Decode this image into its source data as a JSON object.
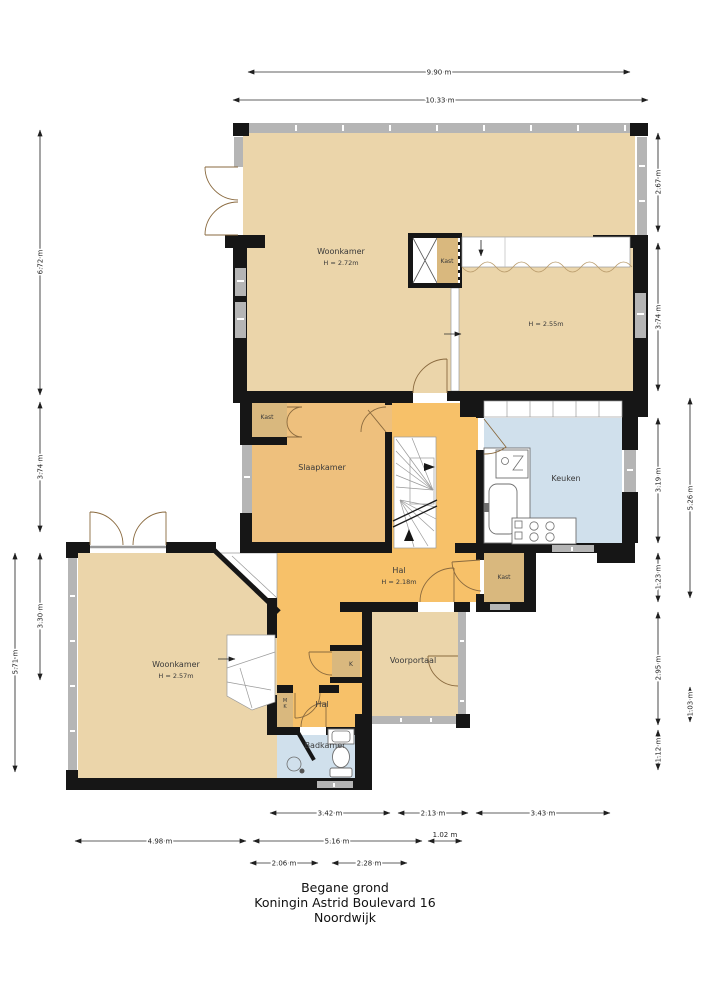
{
  "colors": {
    "room_beige": "#ebd5aa",
    "hall_orange": "#f7c169",
    "slaap_tan": "#eec07d",
    "closet_tan": "#d9b87e",
    "wet_blue": "#d0e0ec",
    "wall_black": "#161616",
    "glass_gray": "#b5b5b5",
    "dim_color": "#2b2b2b",
    "door_color": "#8a6a3f"
  },
  "plan": {
    "rooms": {
      "woonkamer_top": {
        "label": "Woonkamer",
        "height": "H = 2.72m"
      },
      "kast_shaft": {
        "label": "Kast"
      },
      "room_right": {
        "height": "H = 2.55m"
      },
      "kast_slaapkamer": {
        "label": "Kast"
      },
      "slaapkamer": {
        "label": "Slaapkamer"
      },
      "keuken": {
        "label": "Keuken"
      },
      "hal_main": {
        "label": "Hal",
        "height": "H = 2.18m"
      },
      "kast_entry": {
        "label": "Kast"
      },
      "kast_k": {
        "label": "K"
      },
      "meterkast": {
        "line1": "M",
        "line2": "K"
      },
      "voorportaal": {
        "label": "Voorportaal"
      },
      "woonkamer_low": {
        "label": "Woonkamer",
        "height": "H = 2.57m"
      },
      "hal_small": {
        "label": "Hal"
      },
      "badkamer": {
        "label": "Badkamer"
      }
    },
    "dimensions": {
      "top": [
        {
          "label": "9.90 m"
        },
        {
          "label": "10.33 m"
        }
      ],
      "left": [
        {
          "label": "6.72 m"
        },
        {
          "label": "3.74 m"
        },
        {
          "label": "3.30 m"
        },
        {
          "label": "5.71 m"
        }
      ],
      "right": [
        {
          "label": "2.67 m"
        },
        {
          "label": "3.74 m"
        },
        {
          "label": "3.19 m"
        },
        {
          "label": "1.23 m"
        },
        {
          "label": "2.95 m"
        },
        {
          "label": "1.12 m"
        }
      ],
      "right_outer": [
        {
          "label": "5.26 m"
        },
        {
          "label": "1.03 m"
        }
      ],
      "bottom_row1": [
        {
          "label": "3.42 m"
        },
        {
          "label": "2.13 m"
        },
        {
          "label": "3.43 m"
        }
      ],
      "bottom_row2": [
        {
          "label": "4.98 m"
        },
        {
          "label": "5.16 m"
        },
        {
          "label": "1.02 m"
        }
      ],
      "bottom_row3": [
        {
          "label": "2.06 m"
        },
        {
          "label": "2.28 m"
        }
      ]
    },
    "title": {
      "floor": "Begane grond",
      "address": "Koningin Astrid Boulevard 16",
      "city": "Noordwijk"
    }
  }
}
